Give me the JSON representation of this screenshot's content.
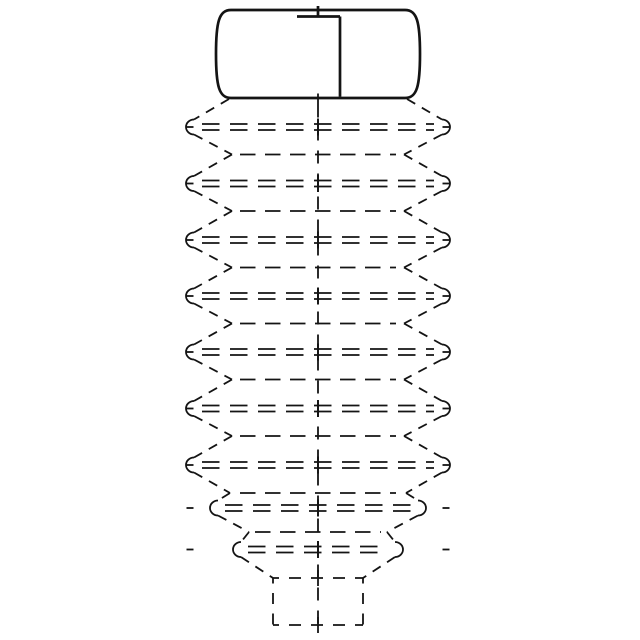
{
  "canvas": {
    "width": 640,
    "height": 640,
    "background_color": "#ffffff",
    "line_color": "#141414",
    "solid_stroke_width": 2.7,
    "hidden_stroke_width": 1.8
  },
  "part": {
    "description": "engineering-drawing-cylindrical-cap-with-hidden-tapered-bellows",
    "center_x": 318,
    "mirror_sum": 636,
    "cap": {
      "outline_path": "M 231 10 L 405 10 C 417 10 420 22 420 54 C 420 86 417 98 405 98 L 231 98 C 219 98 216 86 216 54 C 216 22 219 10 231 10 Z",
      "divider": {
        "x": 340,
        "y1": 16.5,
        "y2": 96.7
      },
      "notch": {
        "y": 16.5,
        "x1": 297,
        "x2": 340
      },
      "top_center_tick": {
        "x": 318,
        "y1": 6,
        "y2": 16.5
      }
    },
    "bellows": {
      "wide_rows": {
        "ys": [
          127,
          183.5,
          240,
          296,
          352,
          408.5,
          465
        ],
        "line_x1": 202,
        "line_x2": 434,
        "line_half_gap": 3,
        "arc_x_left": 194,
        "arc_rx": 8,
        "arc_ry": 7.5,
        "cap_tick_inner": 193.5,
        "cap_tick_outer": 186.5,
        "dash": [
          17.5,
          10.5
        ],
        "center_tick_half": 8.5
      },
      "taper_rows": [
        {
          "y": 508,
          "arc_x_left": 218,
          "line_x1": 225,
          "line_x2": 411
        },
        {
          "y": 549.5,
          "arc_x_left": 241,
          "line_x1": 248,
          "line_x2": 388
        }
      ],
      "narrow_rows": [
        {
          "y": 154.5,
          "line_x1": 240,
          "line_x2": 396
        },
        {
          "y": 211,
          "line_x1": 240,
          "line_x2": 396
        },
        {
          "y": 267.5,
          "line_x1": 240,
          "line_x2": 396
        },
        {
          "y": 323.5,
          "line_x1": 240,
          "line_x2": 396
        },
        {
          "y": 379.5,
          "line_x1": 240,
          "line_x2": 396
        },
        {
          "y": 436,
          "line_x1": 240,
          "line_x2": 396
        },
        {
          "y": 493,
          "line_x1": 240,
          "line_x2": 396
        },
        {
          "y": 532,
          "line_x1": 255,
          "line_x2": 381
        }
      ],
      "narrow_dash": [
        15.5,
        9.5
      ],
      "diagonals_left": [
        [
          229,
          99,
          194,
          119.5
        ],
        [
          194,
          134.5,
          232,
          154.5
        ],
        [
          232,
          154.5,
          194,
          176
        ],
        [
          194,
          191,
          232,
          211
        ],
        [
          232,
          211,
          194,
          232.5
        ],
        [
          194,
          247.5,
          232,
          267.5
        ],
        [
          232,
          267.5,
          194,
          288.5
        ],
        [
          194,
          303.5,
          232,
          323.5
        ],
        [
          232,
          323.5,
          194,
          344.5
        ],
        [
          194,
          359.5,
          232,
          379.5
        ],
        [
          232,
          379.5,
          194,
          401
        ],
        [
          194,
          416,
          232,
          436
        ],
        [
          232,
          436,
          194,
          457.5
        ],
        [
          194,
          472.5,
          230,
          493
        ],
        [
          230,
          493,
          218,
          500.5
        ],
        [
          218,
          515.5,
          249,
          532
        ],
        [
          249,
          532,
          241,
          542
        ],
        [
          241,
          557,
          273,
          578
        ]
      ],
      "diagonal_dash": [
        9.5,
        7.7
      ]
    },
    "stem": {
      "x_left": 273,
      "x_right": 363,
      "top_y": 578,
      "bottom_y": 625,
      "h_dash": [
        12,
        10
      ],
      "h_dashoffset": 6,
      "v_dash": [
        11,
        9.5
      ],
      "v_dashoffset": 5.5
    },
    "centerline": {
      "x": 318,
      "y1": 104.5,
      "y2": 633,
      "dash": [
        13,
        10
      ],
      "ticks": [
        [
          6,
          16.5
        ],
        [
          93.5,
          104.5
        ],
        [
          118.5,
          135.5
        ],
        [
          175,
          192
        ],
        [
          231.5,
          248.5
        ],
        [
          287.5,
          304.5
        ],
        [
          343.5,
          360.5
        ],
        [
          400,
          417
        ],
        [
          456.5,
          473.5
        ],
        [
          499.5,
          516.5
        ],
        [
          541,
          558
        ],
        [
          570,
          586
        ],
        [
          617,
          633
        ]
      ]
    }
  }
}
